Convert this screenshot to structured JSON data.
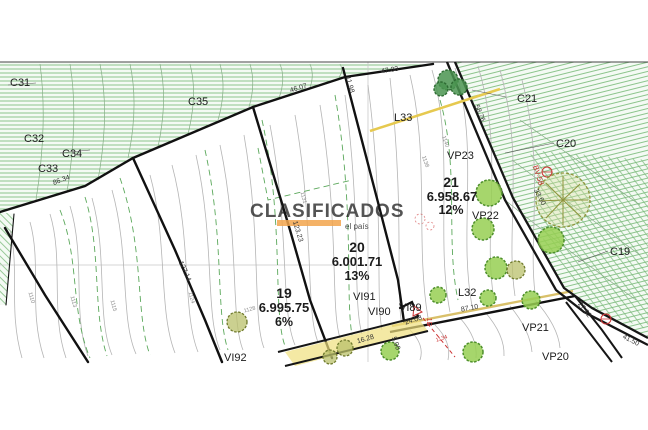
{
  "lots": [
    {
      "number": "19",
      "area": "6.995.75",
      "slope": "6%"
    },
    {
      "number": "20",
      "area": "6.001.71",
      "slope": "13%"
    },
    {
      "number": "21",
      "area": "6.958.67",
      "slope": "12%"
    }
  ],
  "section_labels": {
    "c31": "C31",
    "c32": "C32",
    "c33": "C33",
    "c34": "C34",
    "c35": "C35",
    "c21": "C21",
    "c20": "C20",
    "c19": "C19"
  },
  "point_labels": {
    "l33": "L33",
    "l32": "L32",
    "vp23": "VP23",
    "vp22": "VP22",
    "vp21": "VP21",
    "vp20": "VP20",
    "vi91": "VI91",
    "vi90": "VI90",
    "vi89": "VI89",
    "vi92": "VI92"
  },
  "dimensions": {
    "d86": "86.34",
    "d46": "46.07",
    "d47": "47.03",
    "d11": "11.98",
    "d127": "127.14",
    "d123": "123.23",
    "d58": "58.76",
    "d33": "33.60",
    "d87": "87.10",
    "d27": "27.92",
    "d41": "41.50",
    "d24": "24.08",
    "d16": "16.28",
    "d5": "5.00"
  },
  "elevations": {
    "e1": "1110",
    "e2": "1113",
    "e3": "1115",
    "e4": "1124",
    "e5": "1128",
    "e6": "1131",
    "e7": "1138",
    "e8": "1140",
    "red_elev": "1134"
  },
  "road_marker": "BV-58",
  "corner_marker": "1E",
  "watermark": {
    "text": "CLASIFICADOS",
    "subtext": "el país"
  },
  "colors": {
    "hatch_green": "#8cc48c",
    "tree_bright": "#96cf52",
    "tree_olive": "#b9c06b",
    "tree_dark": "#4a9450",
    "road_tan": "#d9c06a",
    "utility_yellow": "#e6c94f",
    "marker_red": "#cc3333",
    "watermark_bar": "#f2a44c",
    "watermark_text": "#cfb494"
  }
}
